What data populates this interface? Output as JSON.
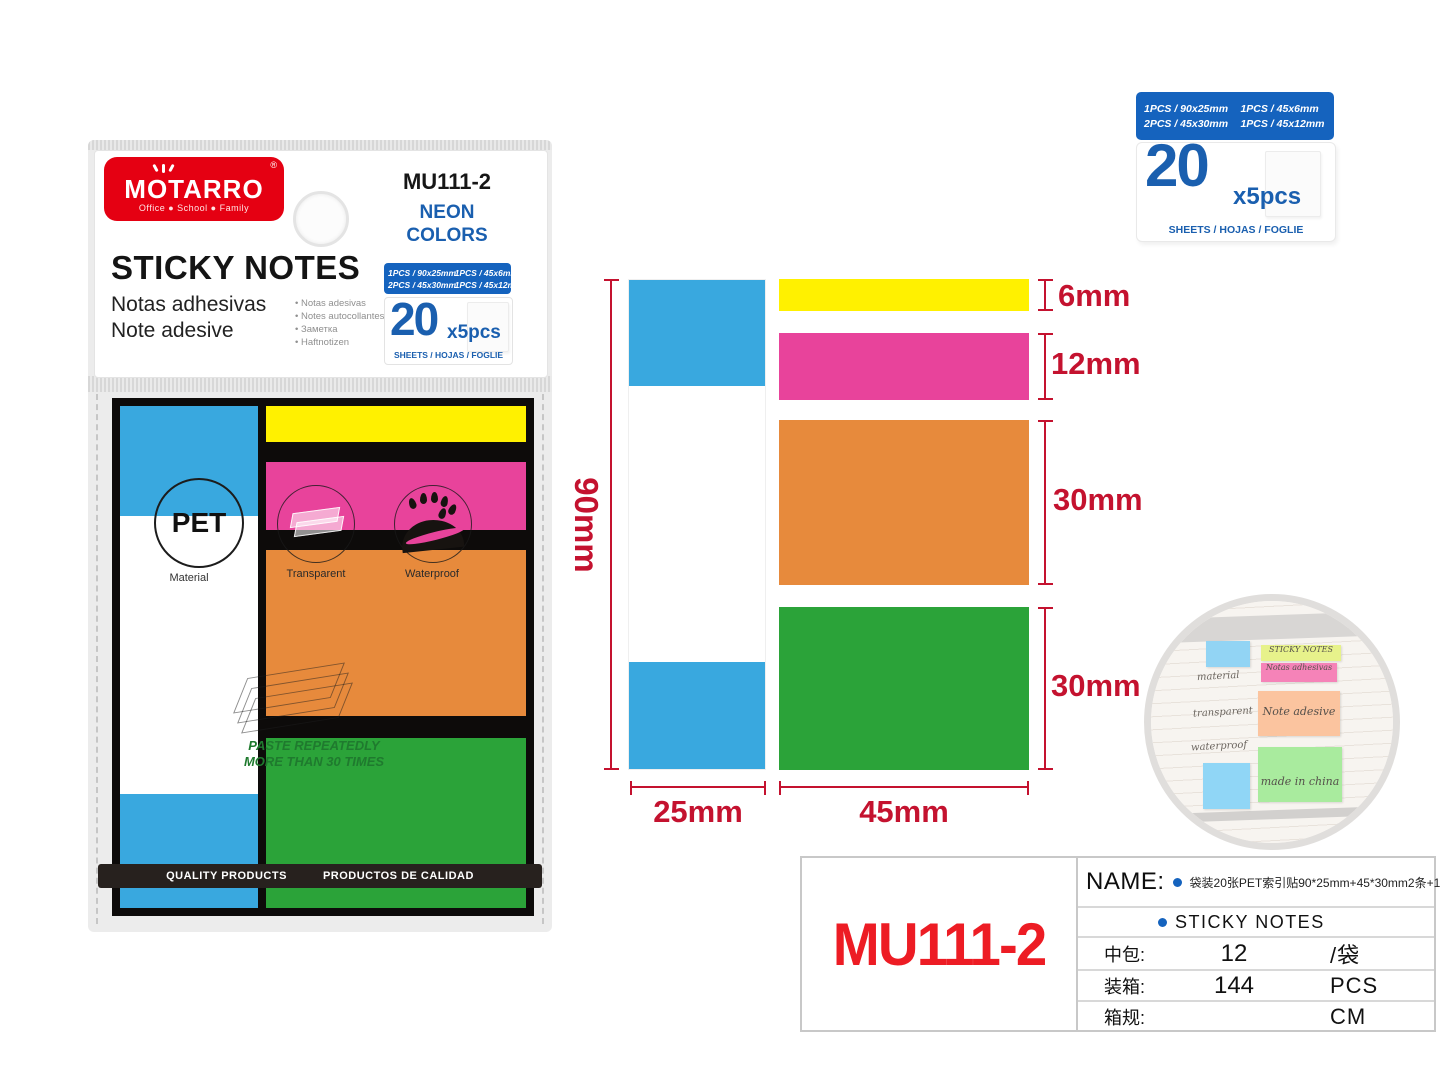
{
  "colors": {
    "brand_red": "#E50012",
    "accent_blue": "#1563BE",
    "deep_blue": "#1A5FAF",
    "note_blue": "#39A8DF",
    "note_yellow": "#FFF100",
    "note_pink": "#E8439B",
    "note_orange": "#E78A3C",
    "note_green": "#2BA339",
    "dimension_red": "#C4122F",
    "model_red": "#ED1C24"
  },
  "specs": [
    "1PCS / 90x25mm",
    "1PCS / 45x6mm",
    "2PCS / 45x30mm",
    "1PCS / 45x12mm"
  ],
  "count": {
    "number": "20",
    "multiplier": "x5pcs",
    "units": "SHEETS / HOJAS / FOGLIE"
  },
  "package": {
    "brand": "MOTARRO",
    "reg": "®",
    "tagline": "Office ● School ● Family",
    "model": "MU111-2",
    "finish_line1": "NEON",
    "finish_line2": "COLORS",
    "title": "STICKY NOTES",
    "subtitle_es": "Notas adhesivas",
    "subtitle_it": "Note adesive",
    "languages": [
      "• Notas adesivas",
      "• Notes autocollantes",
      "• Заметка",
      "• Haftnotizen"
    ],
    "material_badge": "PET",
    "material_label": "Material",
    "feature1": "Transparent",
    "feature2": "Waterproof",
    "paste_line1": "PASTE REPEATEDLY",
    "paste_line2": "MORE THAN 30 TIMES",
    "quality_left": "QUALITY PRODUCTS",
    "quality_right": "PRODUCTOS DE CALIDAD"
  },
  "diagram": {
    "height": "90mm",
    "col_width": "25mm",
    "note_width": "45mm",
    "sizes": [
      "6mm",
      "12mm",
      "30mm",
      "30mm"
    ]
  },
  "photo": {
    "note1": "STICKY NOTES",
    "note2": "Notas adhesivas",
    "note3": "Note adesive",
    "note4": "made in china",
    "hand1": "material",
    "hand2": "transparent",
    "hand3": "waterproof"
  },
  "info": {
    "model": "MU111-2",
    "name_label": "NAME:",
    "name_cn": "袋装20张PET索引贴90*25mm+45*30mm2条+12*45mm+6*45mm 三色混",
    "name_en": "STICKY NOTES",
    "rows": [
      {
        "label": "中包:",
        "value": "12",
        "unit": "/袋"
      },
      {
        "label": "装箱:",
        "value": "144",
        "unit": "PCS"
      },
      {
        "label": "箱规:",
        "value": "",
        "unit": "CM"
      }
    ]
  }
}
